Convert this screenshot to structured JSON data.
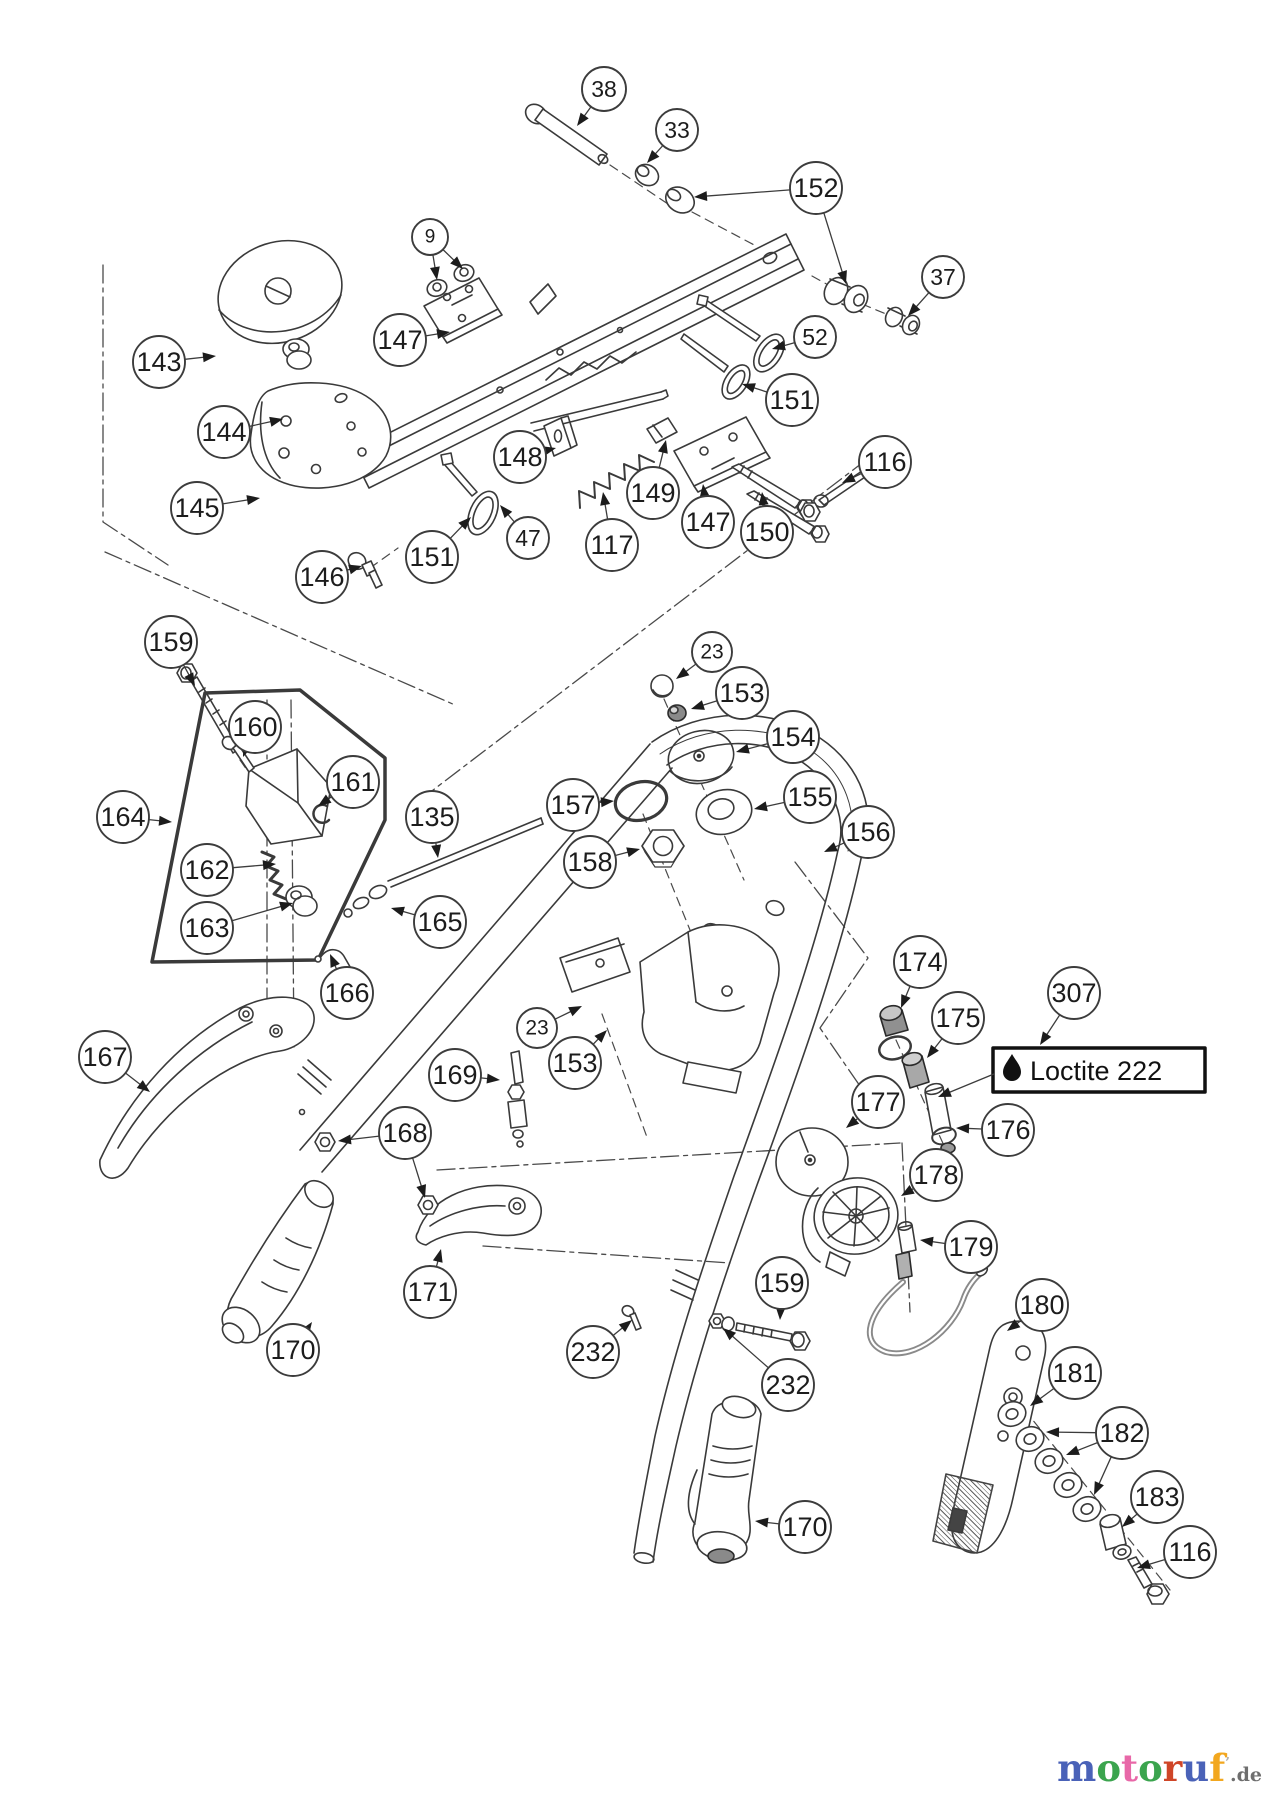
{
  "diagram": {
    "type": "exploded-parts-diagram",
    "loctite": {
      "label": "Loctite 222",
      "icon": "oil-drop-icon",
      "box": {
        "x": 993,
        "y": 1048,
        "w": 212,
        "h": 44
      },
      "leader": {
        "x1": 993,
        "y1": 1074,
        "x2": 938,
        "y2": 1097
      }
    },
    "callouts": [
      {
        "label": "38",
        "cx": 604,
        "cy": 89,
        "r": 22,
        "tips": [
          [
            577,
            126
          ]
        ]
      },
      {
        "label": "33",
        "cx": 677,
        "cy": 130,
        "r": 21,
        "tips": [
          [
            647,
            163
          ]
        ]
      },
      {
        "label": "152",
        "cx": 816,
        "cy": 188,
        "r": 26,
        "tips": [
          [
            694,
            197
          ],
          [
            846,
            284
          ]
        ]
      },
      {
        "label": "9",
        "cx": 430,
        "cy": 237,
        "r": 18,
        "tips": [
          [
            437,
            280
          ],
          [
            463,
            269
          ]
        ]
      },
      {
        "label": "37",
        "cx": 943,
        "cy": 277,
        "r": 21,
        "tips": [
          [
            908,
            316
          ]
        ]
      },
      {
        "label": "143",
        "cx": 159,
        "cy": 362,
        "r": 26,
        "tips": [
          [
            216,
            356
          ]
        ]
      },
      {
        "label": "147",
        "cx": 400,
        "cy": 340,
        "r": 26,
        "tips": [
          [
            450,
            332
          ]
        ]
      },
      {
        "label": "52",
        "cx": 815,
        "cy": 337,
        "r": 21,
        "tips": [
          [
            772,
            349
          ]
        ]
      },
      {
        "label": "151",
        "cx": 792,
        "cy": 400,
        "r": 26,
        "tips": [
          [
            742,
            384
          ]
        ]
      },
      {
        "label": "144",
        "cx": 224,
        "cy": 432,
        "r": 26,
        "tips": [
          [
            283,
            419
          ]
        ]
      },
      {
        "label": "148",
        "cx": 520,
        "cy": 457,
        "r": 26,
        "tips": [
          [
            556,
            448
          ]
        ]
      },
      {
        "label": "116",
        "cx": 885,
        "cy": 462,
        "r": 26,
        "tips": [
          [
            842,
            483
          ]
        ]
      },
      {
        "label": "149",
        "cx": 653,
        "cy": 493,
        "r": 26,
        "tips": [
          [
            666,
            440
          ]
        ]
      },
      {
        "label": "147",
        "cx": 708,
        "cy": 522,
        "r": 26,
        "tips": [
          [
            703,
            484
          ]
        ]
      },
      {
        "label": "145",
        "cx": 197,
        "cy": 508,
        "r": 26,
        "tips": [
          [
            260,
            498
          ]
        ]
      },
      {
        "label": "150",
        "cx": 767,
        "cy": 532,
        "r": 26,
        "tips": [
          [
            762,
            492
          ]
        ]
      },
      {
        "label": "151",
        "cx": 432,
        "cy": 557,
        "r": 26,
        "tips": [
          [
            471,
            517
          ]
        ]
      },
      {
        "label": "47",
        "cx": 528,
        "cy": 538,
        "r": 21,
        "tips": [
          [
            500,
            505
          ]
        ]
      },
      {
        "label": "117",
        "cx": 612,
        "cy": 545,
        "r": 26,
        "tips": [
          [
            603,
            492
          ]
        ]
      },
      {
        "label": "146",
        "cx": 322,
        "cy": 577,
        "r": 26,
        "tips": [
          [
            362,
            566
          ]
        ]
      },
      {
        "label": "159",
        "cx": 171,
        "cy": 642,
        "r": 26,
        "tips": [
          [
            195,
            686
          ]
        ]
      },
      {
        "label": "23",
        "cx": 712,
        "cy": 652,
        "r": 20,
        "tips": [
          [
            676,
            679
          ]
        ]
      },
      {
        "label": "153",
        "cx": 742,
        "cy": 693,
        "r": 26,
        "tips": [
          [
            691,
            709
          ]
        ]
      },
      {
        "label": "160",
        "cx": 255,
        "cy": 727,
        "r": 26,
        "tips": [
          [
            243,
            757
          ]
        ]
      },
      {
        "label": "154",
        "cx": 793,
        "cy": 737,
        "r": 26,
        "tips": [
          [
            736,
            752
          ]
        ]
      },
      {
        "label": "161",
        "cx": 353,
        "cy": 782,
        "r": 26,
        "tips": [
          [
            318,
            806
          ]
        ]
      },
      {
        "label": "155",
        "cx": 810,
        "cy": 797,
        "r": 26,
        "tips": [
          [
            754,
            809
          ]
        ]
      },
      {
        "label": "157",
        "cx": 573,
        "cy": 805,
        "r": 26,
        "tips": [
          [
            614,
            801
          ]
        ]
      },
      {
        "label": "164",
        "cx": 123,
        "cy": 817,
        "r": 26,
        "tips": [
          [
            172,
            822
          ]
        ]
      },
      {
        "label": "135",
        "cx": 432,
        "cy": 817,
        "r": 26,
        "tips": [
          [
            438,
            858
          ]
        ]
      },
      {
        "label": "156",
        "cx": 868,
        "cy": 832,
        "r": 26,
        "tips": [
          [
            824,
            852
          ]
        ]
      },
      {
        "label": "158",
        "cx": 590,
        "cy": 862,
        "r": 26,
        "tips": [
          [
            640,
            849
          ]
        ]
      },
      {
        "label": "162",
        "cx": 207,
        "cy": 870,
        "r": 26,
        "tips": [
          [
            276,
            864
          ]
        ]
      },
      {
        "label": "163",
        "cx": 207,
        "cy": 928,
        "r": 26,
        "tips": [
          [
            293,
            903
          ]
        ]
      },
      {
        "label": "165",
        "cx": 440,
        "cy": 922,
        "r": 26,
        "tips": [
          [
            391,
            908
          ]
        ]
      },
      {
        "label": "166",
        "cx": 347,
        "cy": 993,
        "r": 26,
        "tips": [
          [
            330,
            954
          ]
        ]
      },
      {
        "label": "174",
        "cx": 920,
        "cy": 962,
        "r": 26,
        "tips": [
          [
            901,
            1008
          ]
        ]
      },
      {
        "label": "307",
        "cx": 1074,
        "cy": 993,
        "r": 26,
        "tips": [
          [
            1040,
            1045
          ]
        ]
      },
      {
        "label": "175",
        "cx": 958,
        "cy": 1018,
        "r": 26,
        "tips": [
          [
            927,
            1058
          ]
        ]
      },
      {
        "label": "167",
        "cx": 105,
        "cy": 1057,
        "r": 26,
        "tips": [
          [
            150,
            1092
          ]
        ]
      },
      {
        "label": "23",
        "cx": 537,
        "cy": 1028,
        "r": 20,
        "tips": [
          [
            582,
            1006
          ]
        ]
      },
      {
        "label": "153",
        "cx": 575,
        "cy": 1063,
        "r": 26,
        "tips": [
          [
            607,
            1030
          ]
        ]
      },
      {
        "label": "169",
        "cx": 455,
        "cy": 1075,
        "r": 26,
        "tips": [
          [
            500,
            1080
          ]
        ]
      },
      {
        "label": "177",
        "cx": 878,
        "cy": 1102,
        "r": 26,
        "tips": [
          [
            846,
            1128
          ]
        ]
      },
      {
        "label": "176",
        "cx": 1008,
        "cy": 1130,
        "r": 26,
        "tips": [
          [
            956,
            1128
          ]
        ]
      },
      {
        "label": "168",
        "cx": 405,
        "cy": 1133,
        "r": 26,
        "tips": [
          [
            338,
            1141
          ],
          [
            425,
            1198
          ]
        ]
      },
      {
        "label": "178",
        "cx": 936,
        "cy": 1175,
        "r": 26,
        "tips": [
          [
            901,
            1196
          ]
        ]
      },
      {
        "label": "179",
        "cx": 971,
        "cy": 1247,
        "r": 26,
        "tips": [
          [
            920,
            1240
          ]
        ]
      },
      {
        "label": "171",
        "cx": 430,
        "cy": 1292,
        "r": 26,
        "tips": [
          [
            441,
            1249
          ]
        ]
      },
      {
        "label": "159",
        "cx": 782,
        "cy": 1283,
        "r": 26,
        "tips": [
          [
            780,
            1320
          ]
        ]
      },
      {
        "label": "180",
        "cx": 1042,
        "cy": 1305,
        "r": 26,
        "tips": [
          [
            1007,
            1331
          ]
        ]
      },
      {
        "label": "170",
        "cx": 293,
        "cy": 1350,
        "r": 26,
        "tips": [
          [
            312,
            1322
          ]
        ]
      },
      {
        "label": "232",
        "cx": 593,
        "cy": 1352,
        "r": 26,
        "tips": [
          [
            632,
            1320
          ]
        ]
      },
      {
        "label": "181",
        "cx": 1075,
        "cy": 1373,
        "r": 26,
        "tips": [
          [
            1030,
            1406
          ]
        ]
      },
      {
        "label": "232",
        "cx": 788,
        "cy": 1385,
        "r": 26,
        "tips": [
          [
            723,
            1328
          ]
        ]
      },
      {
        "label": "182",
        "cx": 1122,
        "cy": 1433,
        "r": 26,
        "tips": [
          [
            1046,
            1432
          ],
          [
            1066,
            1455
          ],
          [
            1094,
            1495
          ]
        ]
      },
      {
        "label": "183",
        "cx": 1157,
        "cy": 1497,
        "r": 26,
        "tips": [
          [
            1122,
            1527
          ]
        ]
      },
      {
        "label": "116",
        "cx": 1190,
        "cy": 1552,
        "r": 26,
        "tips": [
          [
            1137,
            1568
          ]
        ]
      },
      {
        "label": "170",
        "cx": 805,
        "cy": 1527,
        "r": 26,
        "tips": [
          [
            755,
            1521
          ]
        ]
      }
    ]
  },
  "watermark": {
    "letters": [
      {
        "ch": "m",
        "color": "#4a62b8"
      },
      {
        "ch": "o",
        "color": "#3ba44e"
      },
      {
        "ch": "t",
        "color": "#e868a8"
      },
      {
        "ch": "o",
        "color": "#3ba44e"
      },
      {
        "ch": "r",
        "color": "#cf4527"
      },
      {
        "ch": "u",
        "color": "#4a62b8"
      },
      {
        "ch": "f",
        "color": "#f2a71f"
      }
    ],
    "mark": "’",
    "mark_color": "#b0b0b0",
    "suffix": ".de",
    "suffix_color": "#6e6e6e"
  }
}
